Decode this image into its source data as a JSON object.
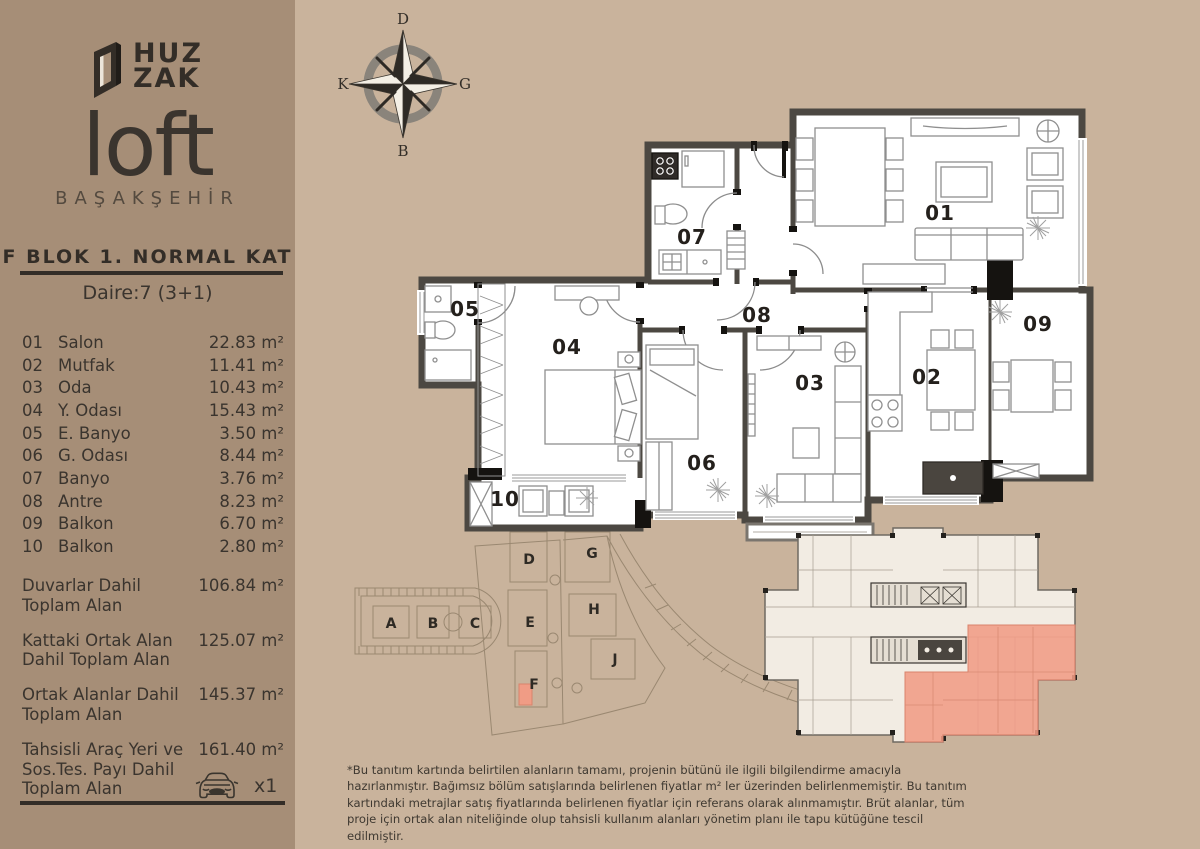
{
  "colors": {
    "background": "#c9b39c",
    "sidebar": "#a68e77",
    "ink": "#332d27",
    "wall": "#4c4842",
    "highlight": "#f09c85"
  },
  "logo": {
    "brand_top": "HUZ",
    "brand_bottom": "ZAK",
    "name": "loft",
    "location": "BAŞAKŞEHİR"
  },
  "header": {
    "block_title": "F BLOK 1. NORMAL KAT",
    "unit_title": "Daire:7 (3+1)"
  },
  "rooms": [
    {
      "num": "01",
      "label": "Salon",
      "area": "22.83 m²"
    },
    {
      "num": "02",
      "label": "Mutfak",
      "area": "11.41 m²"
    },
    {
      "num": "03",
      "label": "Oda",
      "area": "10.43 m²"
    },
    {
      "num": "04",
      "label": "Y. Odası",
      "area": "15.43 m²"
    },
    {
      "num": "05",
      "label": "E. Banyo",
      "area": "3.50 m²"
    },
    {
      "num": "06",
      "label": "G. Odası",
      "area": "8.44 m²"
    },
    {
      "num": "07",
      "label": "Banyo",
      "area": "3.76 m²"
    },
    {
      "num": "08",
      "label": "Antre",
      "area": "8.23 m²"
    },
    {
      "num": "09",
      "label": "Balkon",
      "area": "6.70 m²"
    },
    {
      "num": "10",
      "label": "Balkon",
      "area": "2.80 m²"
    }
  ],
  "totals": [
    {
      "label": "Duvarlar Dahil Toplam Alan",
      "value": "106.84 m²"
    },
    {
      "label": "Kattaki Ortak Alan Dahil Toplam Alan",
      "value": "125.07 m²"
    },
    {
      "label": "Ortak Alanlar Dahil Toplam Alan",
      "value": "145.37 m²"
    },
    {
      "label": "Tahsisli Araç Yeri ve Sos.Tes. Payı Dahil Toplam Alan",
      "value": "161.40 m²"
    }
  ],
  "parking": {
    "count_label": "x1"
  },
  "compass": {
    "top": "D",
    "right": "G",
    "bottom": "B",
    "left": "K"
  },
  "siteplan": {
    "blocks": [
      "A",
      "B",
      "C",
      "D",
      "E",
      "F",
      "G",
      "H",
      "J"
    ],
    "highlighted_block": "F"
  },
  "disclaimer": "*Bu tanıtım kartında belirtilen alanların tamamı, projenin bütünü ile ilgili bilgilendirme amacıyla hazırlanmıştır. Bağımsız bölüm satışlarında belirlenen fiyatlar m² ler üzerinden belirlenmemiştir. Bu tanıtım kartındaki metrajlar satış fiyatlarında belirlenen fiyatlar için referans olarak alınmamıştır. Brüt alanlar, tüm proje için ortak alan niteliğinde olup tahsisli kullanım alanları yönetim planı ile tapu kütüğüne tescil edilmiştir."
}
